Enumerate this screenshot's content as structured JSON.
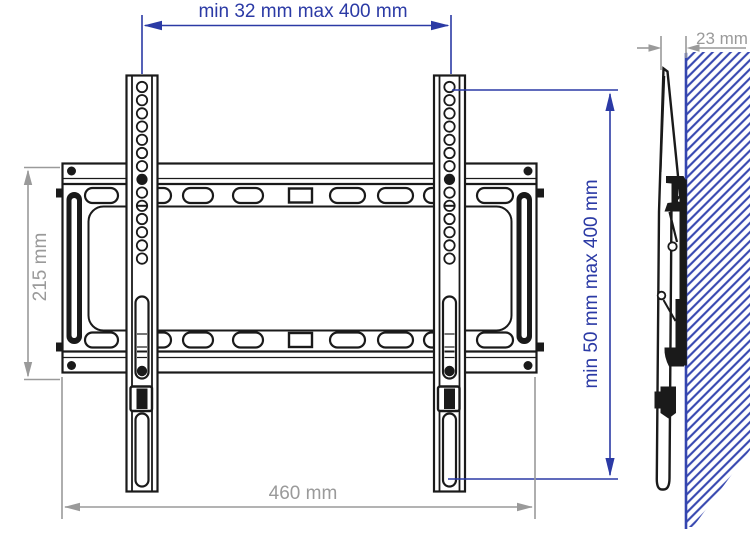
{
  "colors": {
    "dimension_blue": "#2b3aa5",
    "dimension_gray": "#9a9a9a",
    "line_black": "#1a1a1a",
    "hatch_blue": "#3445af",
    "background": "#ffffff"
  },
  "dimensions": {
    "top_horizontal": {
      "label": "min 32 mm max 400 mm"
    },
    "left_vertical": {
      "label": "215 mm"
    },
    "right_vertical": {
      "label": "min 50 mm max 400 mm"
    },
    "bottom_horizontal": {
      "label": "460 mm"
    },
    "wall_offset": {
      "label": "23 mm"
    }
  }
}
